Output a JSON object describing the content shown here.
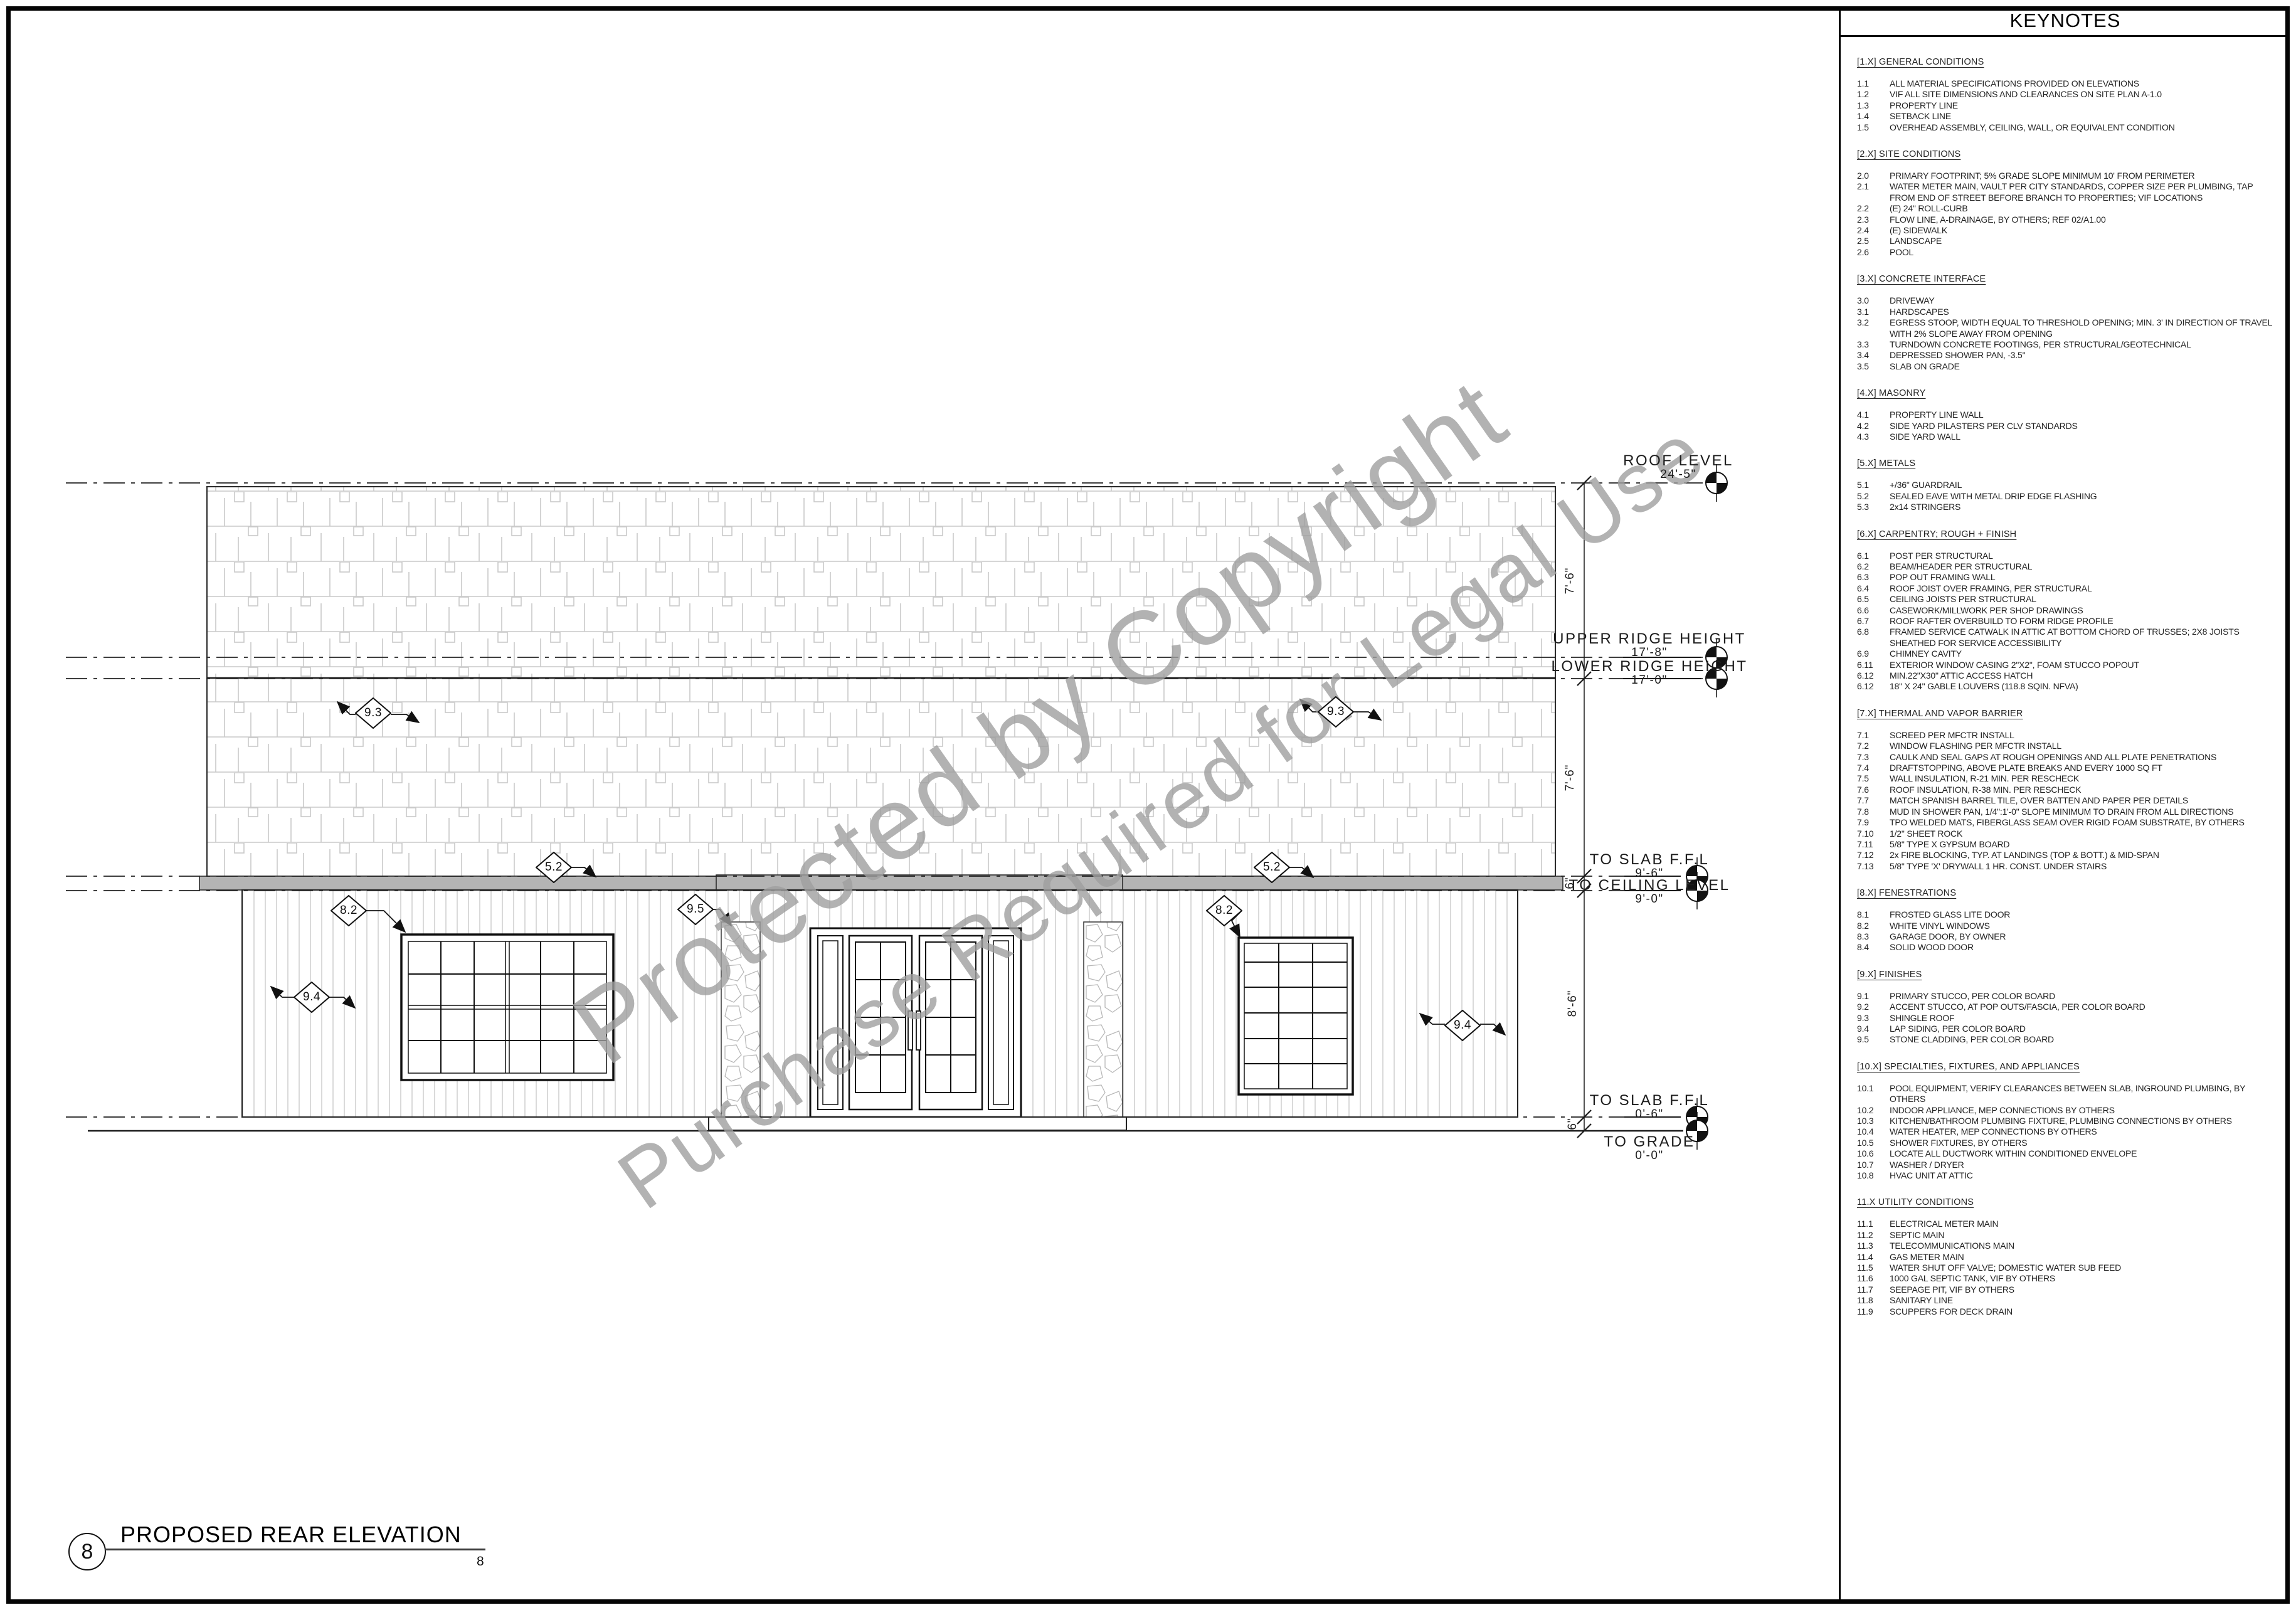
{
  "watermark": {
    "line1": "Protected by Copyright",
    "line2": "Purchase Required for Legal Use"
  },
  "title_block": {
    "number": "8",
    "title": "PROPOSED REAR ELEVATION",
    "sub_number": "8"
  },
  "levels": [
    {
      "name": "ROOF LEVEL",
      "elev": "24'-5\""
    },
    {
      "name": "UPPER RIDGE HEIGHT",
      "elev": "17'-8\""
    },
    {
      "name": "LOWER RIDGE HEIGHT",
      "elev": "17'-0\""
    },
    {
      "name": "TO SLAB F.F.L",
      "elev": "9'-6\""
    },
    {
      "name": "TO CEILING LEVEL",
      "elev": "9'-0\""
    },
    {
      "name": "TO SLAB F.F.L",
      "elev": "0'-6\""
    },
    {
      "name": "TO GRADE",
      "elev": "0'-0\""
    }
  ],
  "dims": [
    {
      "text": "7'-6\""
    },
    {
      "text": "7'-6\""
    },
    {
      "text": "6\""
    },
    {
      "text": "8'-6\""
    },
    {
      "text": "6\""
    }
  ],
  "markers": [
    {
      "label": "9.3"
    },
    {
      "label": "9.3"
    },
    {
      "label": "5.2"
    },
    {
      "label": "5.2"
    },
    {
      "label": "8.2"
    },
    {
      "label": "9.5"
    },
    {
      "label": "8.2"
    },
    {
      "label": "9.4"
    },
    {
      "label": "9.4"
    }
  ],
  "keynotes": {
    "title": "KEYNOTES",
    "sections": [
      {
        "heading": "[1.X] GENERAL CONDITIONS",
        "items": [
          {
            "n": "1.1",
            "t": "ALL MATERIAL SPECIFICATIONS PROVIDED ON ELEVATIONS"
          },
          {
            "n": "1.2",
            "t": "VIF ALL SITE DIMENSIONS AND CLEARANCES ON SITE PLAN A-1.0"
          },
          {
            "n": "1.3",
            "t": "PROPERTY LINE"
          },
          {
            "n": "1.4",
            "t": "SETBACK LINE"
          },
          {
            "n": "1.5",
            "t": "OVERHEAD ASSEMBLY, CEILING, WALL, OR EQUIVALENT CONDITION"
          }
        ]
      },
      {
        "heading": "[2.X] SITE CONDITIONS",
        "items": [
          {
            "n": "2.0",
            "t": "PRIMARY FOOTPRINT; 5% GRADE SLOPE MINIMUM 10' FROM PERIMETER"
          },
          {
            "n": "2.1",
            "t": "WATER METER MAIN, VAULT PER CITY STANDARDS, COPPER SIZE PER PLUMBING, TAP FROM END OF STREET BEFORE BRANCH TO PROPERTIES; VIF LOCATIONS"
          },
          {
            "n": "2.2",
            "t": "(E) 24\" ROLL-CURB"
          },
          {
            "n": "2.3",
            "t": "FLOW LINE, A-DRAINAGE, BY OTHERS; REF 02/A1.00"
          },
          {
            "n": "2.4",
            "t": "(E) SIDEWALK"
          },
          {
            "n": "2.5",
            "t": "LANDSCAPE"
          },
          {
            "n": "2.6",
            "t": "POOL"
          }
        ]
      },
      {
        "heading": "[3.X] CONCRETE INTERFACE",
        "items": [
          {
            "n": "3.0",
            "t": "DRIVEWAY"
          },
          {
            "n": "3.1",
            "t": "HARDSCAPES"
          },
          {
            "n": "3.2",
            "t": "EGRESS STOOP, WIDTH EQUAL TO THRESHOLD OPENING; MIN. 3' IN DIRECTION OF TRAVEL WITH 2% SLOPE AWAY FROM OPENING"
          },
          {
            "n": "3.3",
            "t": "TURNDOWN CONCRETE FOOTINGS, PER STRUCTURAL/GEOTECHNICAL"
          },
          {
            "n": "3.4",
            "t": "DEPRESSED SHOWER PAN, -3.5\""
          },
          {
            "n": "3.5",
            "t": "SLAB ON GRADE"
          }
        ]
      },
      {
        "heading": "[4.X] MASONRY",
        "items": [
          {
            "n": "4.1",
            "t": "PROPERTY LINE WALL"
          },
          {
            "n": "4.2",
            "t": "SIDE YARD PILASTERS PER CLV STANDARDS"
          },
          {
            "n": "4.3",
            "t": "SIDE YARD WALL"
          }
        ]
      },
      {
        "heading": "[5.X] METALS",
        "items": [
          {
            "n": "5.1",
            "t": "+/36\" GUARDRAIL"
          },
          {
            "n": "5.2",
            "t": "SEALED EAVE WITH METAL DRIP EDGE FLASHING"
          },
          {
            "n": "5.3",
            "t": "2x14 STRINGERS"
          }
        ]
      },
      {
        "heading": "[6.X] CARPENTRY; ROUGH + FINISH",
        "items": [
          {
            "n": "6.1",
            "t": "POST PER STRUCTURAL"
          },
          {
            "n": "6.2",
            "t": "BEAM/HEADER PER STRUCTURAL"
          },
          {
            "n": "6.3",
            "t": "POP OUT FRAMING WALL"
          },
          {
            "n": "6.4",
            "t": "ROOF JOIST OVER FRAMING, PER STRUCTURAL"
          },
          {
            "n": "6.5",
            "t": "CEILING JOISTS PER STRUCTURAL"
          },
          {
            "n": "6.6",
            "t": "CASEWORK/MILLWORK PER SHOP DRAWINGS"
          },
          {
            "n": "6.7",
            "t": "ROOF RAFTER OVERBUILD TO FORM RIDGE PROFILE"
          },
          {
            "n": "6.8",
            "t": "FRAMED SERVICE CATWALK IN ATTIC AT BOTTOM CHORD OF TRUSSES; 2X8 JOISTS SHEATHED FOR SERVICE ACCESSIBILITY"
          },
          {
            "n": "6.9",
            "t": "CHIMNEY CAVITY"
          },
          {
            "n": "6.11",
            "t": "EXTERIOR WINDOW CASING 2\"X2\", FOAM STUCCO POPOUT"
          },
          {
            "n": "6.12",
            "t": "MIN.22\"X30\" ATTIC ACCESS HATCH"
          },
          {
            "n": "6.12",
            "t": "18\" X 24\" GABLE LOUVERS (118.8 SQIN. NFVA)"
          }
        ]
      },
      {
        "heading": "[7.X] THERMAL AND VAPOR BARRIER",
        "items": [
          {
            "n": "7.1",
            "t": "SCREED PER MFCTR INSTALL"
          },
          {
            "n": "7.2",
            "t": "WINDOW FLASHING PER MFCTR INSTALL"
          },
          {
            "n": "7.3",
            "t": "CAULK AND SEAL GAPS AT ROUGH OPENINGS AND ALL PLATE PENETRATIONS"
          },
          {
            "n": "7.4",
            "t": "DRAFTSTOPPING, ABOVE PLATE BREAKS AND EVERY 1000 SQ FT"
          },
          {
            "n": "7.5",
            "t": "WALL INSULATION, R-21 MIN. PER RESCHECK"
          },
          {
            "n": "7.6",
            "t": "ROOF INSULATION, R-38 MIN. PER RESCHECK"
          },
          {
            "n": "7.7",
            "t": "MATCH SPANISH BARREL TILE, OVER BATTEN AND PAPER PER DETAILS"
          },
          {
            "n": "7.8",
            "t": "MUD IN SHOWER PAN, 1/4\":1'-0\" SLOPE MINIMUM TO DRAIN FROM ALL DIRECTIONS"
          },
          {
            "n": "7.9",
            "t": "TPO WELDED MATS, FIBERGLASS SEAM OVER RIGID FOAM SUBSTRATE, BY OTHERS"
          },
          {
            "n": "7.10",
            "t": "1/2\" SHEET ROCK"
          },
          {
            "n": "7.11",
            "t": "5/8\" TYPE X GYPSUM BOARD"
          },
          {
            "n": "7.12",
            "t": "2x FIRE BLOCKING, TYP. AT LANDINGS (TOP & BOTT.) & MID-SPAN"
          },
          {
            "n": "7.13",
            "t": "5/8\" TYPE 'X' DRYWALL 1 HR. CONST. UNDER STAIRS"
          }
        ]
      },
      {
        "heading": "[8.X] FENESTRATIONS",
        "items": [
          {
            "n": "8.1",
            "t": "FROSTED GLASS LITE DOOR"
          },
          {
            "n": "8.2",
            "t": "WHITE VINYL WINDOWS"
          },
          {
            "n": "8.3",
            "t": "GARAGE DOOR, BY OWNER"
          },
          {
            "n": "8.4",
            "t": "SOLID WOOD DOOR"
          }
        ]
      },
      {
        "heading": "[9.X] FINISHES",
        "items": [
          {
            "n": "9.1",
            "t": "PRIMARY STUCCO, PER COLOR BOARD"
          },
          {
            "n": "9.2",
            "t": "ACCENT STUCCO, AT POP OUTS/FASCIA, PER COLOR BOARD"
          },
          {
            "n": "9.3",
            "t": "SHINGLE ROOF"
          },
          {
            "n": "9.4",
            "t": "LAP SIDING, PER COLOR BOARD"
          },
          {
            "n": "9.5",
            "t": "STONE CLADDING, PER COLOR BOARD"
          }
        ]
      },
      {
        "heading": "[10.X] SPECIALTIES, FIXTURES, AND APPLIANCES",
        "items": [
          {
            "n": "10.1",
            "t": "POOL EQUIPMENT, VERIFY CLEARANCES BETWEEN SLAB, INGROUND PLUMBING, BY OTHERS"
          },
          {
            "n": "10.2",
            "t": "INDOOR APPLIANCE, MEP CONNECTIONS BY OTHERS"
          },
          {
            "n": "10.3",
            "t": "KITCHEN/BATHROOM PLUMBING FIXTURE, PLUMBING CONNECTIONS BY OTHERS"
          },
          {
            "n": "10.4",
            "t": "WATER HEATER, MEP CONNECTIONS BY OTHERS"
          },
          {
            "n": "10.5",
            "t": "SHOWER FIXTURES, BY OTHERS"
          },
          {
            "n": "10.6",
            "t": "LOCATE ALL DUCTWORK WITHIN CONDITIONED ENVELOPE"
          },
          {
            "n": "10.7",
            "t": "WASHER / DRYER"
          },
          {
            "n": "10.8",
            "t": "HVAC UNIT AT ATTIC"
          }
        ]
      },
      {
        "heading": "11.X UTILITY CONDITIONS",
        "items": [
          {
            "n": "11.1",
            "t": "ELECTRICAL METER MAIN"
          },
          {
            "n": "11.2",
            "t": "SEPTIC MAIN"
          },
          {
            "n": "11.3",
            "t": "TELECOMMUNICATIONS MAIN"
          },
          {
            "n": "11.4",
            "t": "GAS METER MAIN"
          },
          {
            "n": "11.5",
            "t": "WATER SHUT OFF VALVE; DOMESTIC WATER SUB FEED"
          },
          {
            "n": "11.6",
            "t": "1000 GAL SEPTIC TANK, VIF BY OTHERS"
          },
          {
            "n": "11.7",
            "t": "SEEPAGE PIT, VIF BY OTHERS"
          },
          {
            "n": "11.8",
            "t": "SANITARY LINE"
          },
          {
            "n": "11.9",
            "t": "SCUPPERS FOR DECK DRAIN"
          }
        ]
      }
    ]
  }
}
